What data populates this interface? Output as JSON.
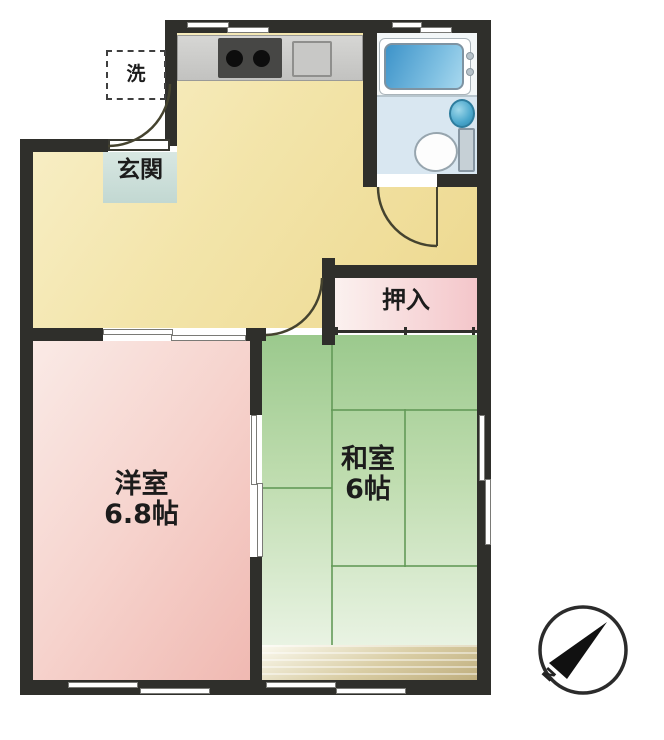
{
  "floorplan": {
    "entrance": {
      "label": "玄関"
    },
    "laundry": {
      "label": "洗"
    },
    "closet": {
      "label": "押入"
    },
    "western_room": {
      "label": "洋室",
      "size": "6.8帖"
    },
    "japanese_room": {
      "label": "和室",
      "size": "6帖"
    },
    "compass": {
      "north_label": "N"
    },
    "colors": {
      "wall": "#2f2f2b",
      "dining_kitchen_floor": "#f3e5ab",
      "western_room_floor": "#f3c8c1",
      "japanese_room_floor": "#aed3a0",
      "closet_floor": "#f4c6ca",
      "entrance_tile": "#cfe2db",
      "bathtub": "#4e9fd0",
      "toilet_floor": "#d9e7f1",
      "veranda": "#cfc098"
    }
  }
}
